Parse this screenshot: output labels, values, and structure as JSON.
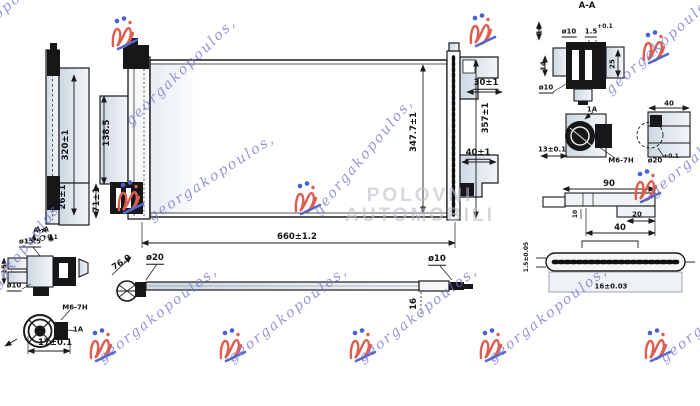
{
  "labels": {
    "left_view": {
      "height": "320±1",
      "depth": "26±1",
      "section_mark": "A-A"
    },
    "main_view": {
      "bracket_height": "138.5",
      "fitting_height": "71±1",
      "core_height": "347.7±1",
      "overall_height": "357±1",
      "top_offset": "30±1",
      "bottom_offset": "40±1",
      "overall_width": "660±1.2"
    },
    "section_detail": {
      "title": "A-A",
      "wall": "10",
      "pipe_dia": "ø10",
      "gap": "1.5",
      "gap_tol": "+0.1",
      "depth": "14",
      "height": "25",
      "pipe_dia_bottom": "ø10"
    },
    "inlet_fitting": {
      "callout": "1A",
      "offset": "13±0.1",
      "thread": "M6-7H",
      "bore_dia": "ø20",
      "bore_tol": "+0.1",
      "width": "40"
    },
    "mount_bracket": {
      "length": "90",
      "tab": "10",
      "step": "20",
      "base": "40"
    },
    "fin": {
      "pitch": "1.5±0.05",
      "width": "16±0.03"
    },
    "pipe": {
      "bend_angle": "76.9",
      "inlet_dia": "ø20",
      "outlet_dia": "ø10",
      "end_length": "16"
    },
    "outlet_fitting": {
      "section_mark": "A-A",
      "flange_dia": "ø15.5",
      "flange_tol": "+0.1",
      "depth": "15",
      "pipe_dia": "ø10",
      "thread": "M6-7H",
      "callout": "1A",
      "length": "17±0.1"
    }
  },
  "watermarks": {
    "script": "georgakopoulos,",
    "center_line1": "POLOVNI",
    "center_line2": "AUTOMOBILI"
  },
  "colors": {
    "line": "#1b1b1b",
    "panel_fill": "#e4eaf1",
    "script_purple": "#7d7fd2",
    "logo_red": "#dd5f50",
    "logo_blue": "#4a5fd0",
    "center_gray": "#c9ced4"
  }
}
